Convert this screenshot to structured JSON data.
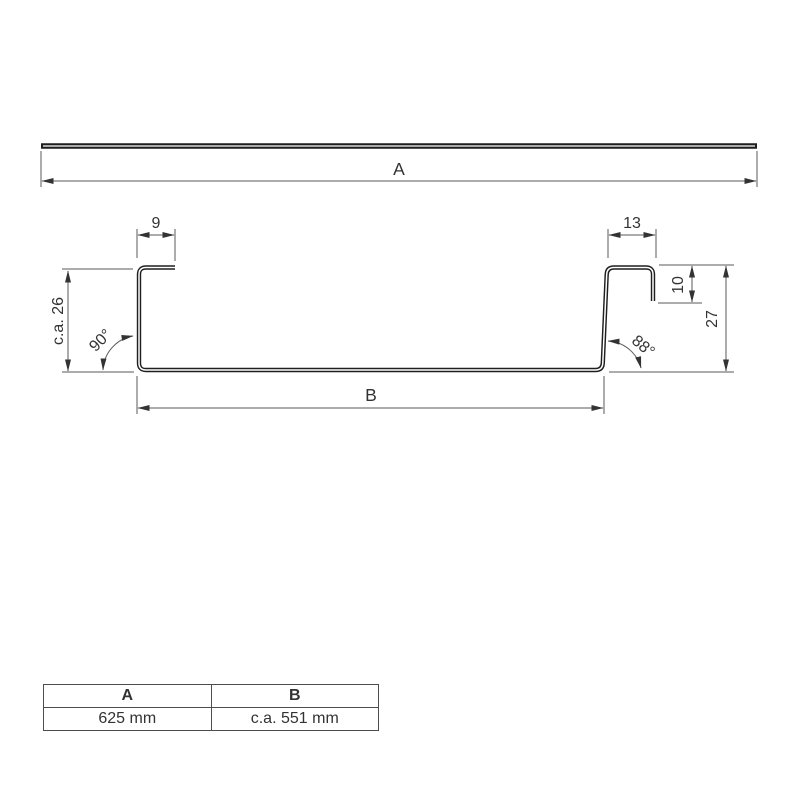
{
  "colors": {
    "profile": "#1f1f1f",
    "dim": "#5a5a5a",
    "text": "#333333"
  },
  "top_view": {
    "dim_a_label": "A"
  },
  "profile_view": {
    "dim_left_flange": "9",
    "dim_right_flange": "13",
    "dim_left_height": "c.a. 26",
    "dim_lip": "10",
    "dim_right_height": "27",
    "angle_left": "90°",
    "angle_right": "88°",
    "dim_b_label": "B"
  },
  "table": {
    "headers": [
      "A",
      "B"
    ],
    "values": [
      "625 mm",
      "c.a. 551 mm"
    ]
  }
}
